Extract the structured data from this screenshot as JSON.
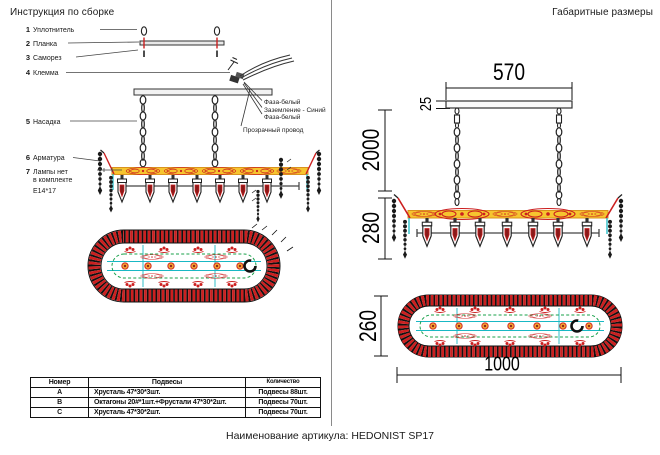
{
  "document": {
    "left_title": "Инструкция по сборке",
    "right_title": "Габаритные размеры",
    "footer": "Наименование артикула: HEDONIST SP17"
  },
  "parts": [
    {
      "num": "1",
      "label": "Уплотнитель"
    },
    {
      "num": "2",
      "label": "Планка"
    },
    {
      "num": "3",
      "label": "Саморез"
    },
    {
      "num": "4",
      "label": "Клемма"
    },
    {
      "num": "5",
      "label": "Насадка"
    },
    {
      "num": "6",
      "label": "Арматура"
    },
    {
      "num": "7",
      "label": "Лампы нет",
      "label_line2": "в комплекте",
      "label_line3": "Е14*17"
    }
  ],
  "wires": {
    "phase_top": "Фаза-белый",
    "ground": "Заземление - Синий",
    "phase_bottom": "Фаза-белый",
    "transparent": "Прозрачный провод"
  },
  "dimensions": {
    "canopy_width": "570",
    "canopy_height": "25",
    "suspension_length": "2000",
    "body_height": "280",
    "oval_height": "260",
    "oval_width": "1000"
  },
  "table": {
    "headers": [
      "Номер",
      "Подвесы",
      "Количество"
    ],
    "rows": [
      {
        "num": "A",
        "pendants": "Хрусталь 47*30*3шт.",
        "qty": "Подвесы 88шт."
      },
      {
        "num": "B",
        "pendants": "Октагоны 20#*1шт.+Фрустали 47*30*2шт.",
        "qty": "Подвесы 70шт."
      },
      {
        "num": "C",
        "pendants": "Хрусталь 47*30*2шт.",
        "qty": "Подвесы 70шт."
      }
    ]
  },
  "colors": {
    "decor_red": "#cc1f1f",
    "band_yellow": "#f6c52f",
    "line_cyan": "#19b8c4",
    "line_green": "#18a04a",
    "marker_orange": "#f0a030",
    "core_darkred": "#8b1a1a",
    "ink": "#1a1a1a"
  }
}
